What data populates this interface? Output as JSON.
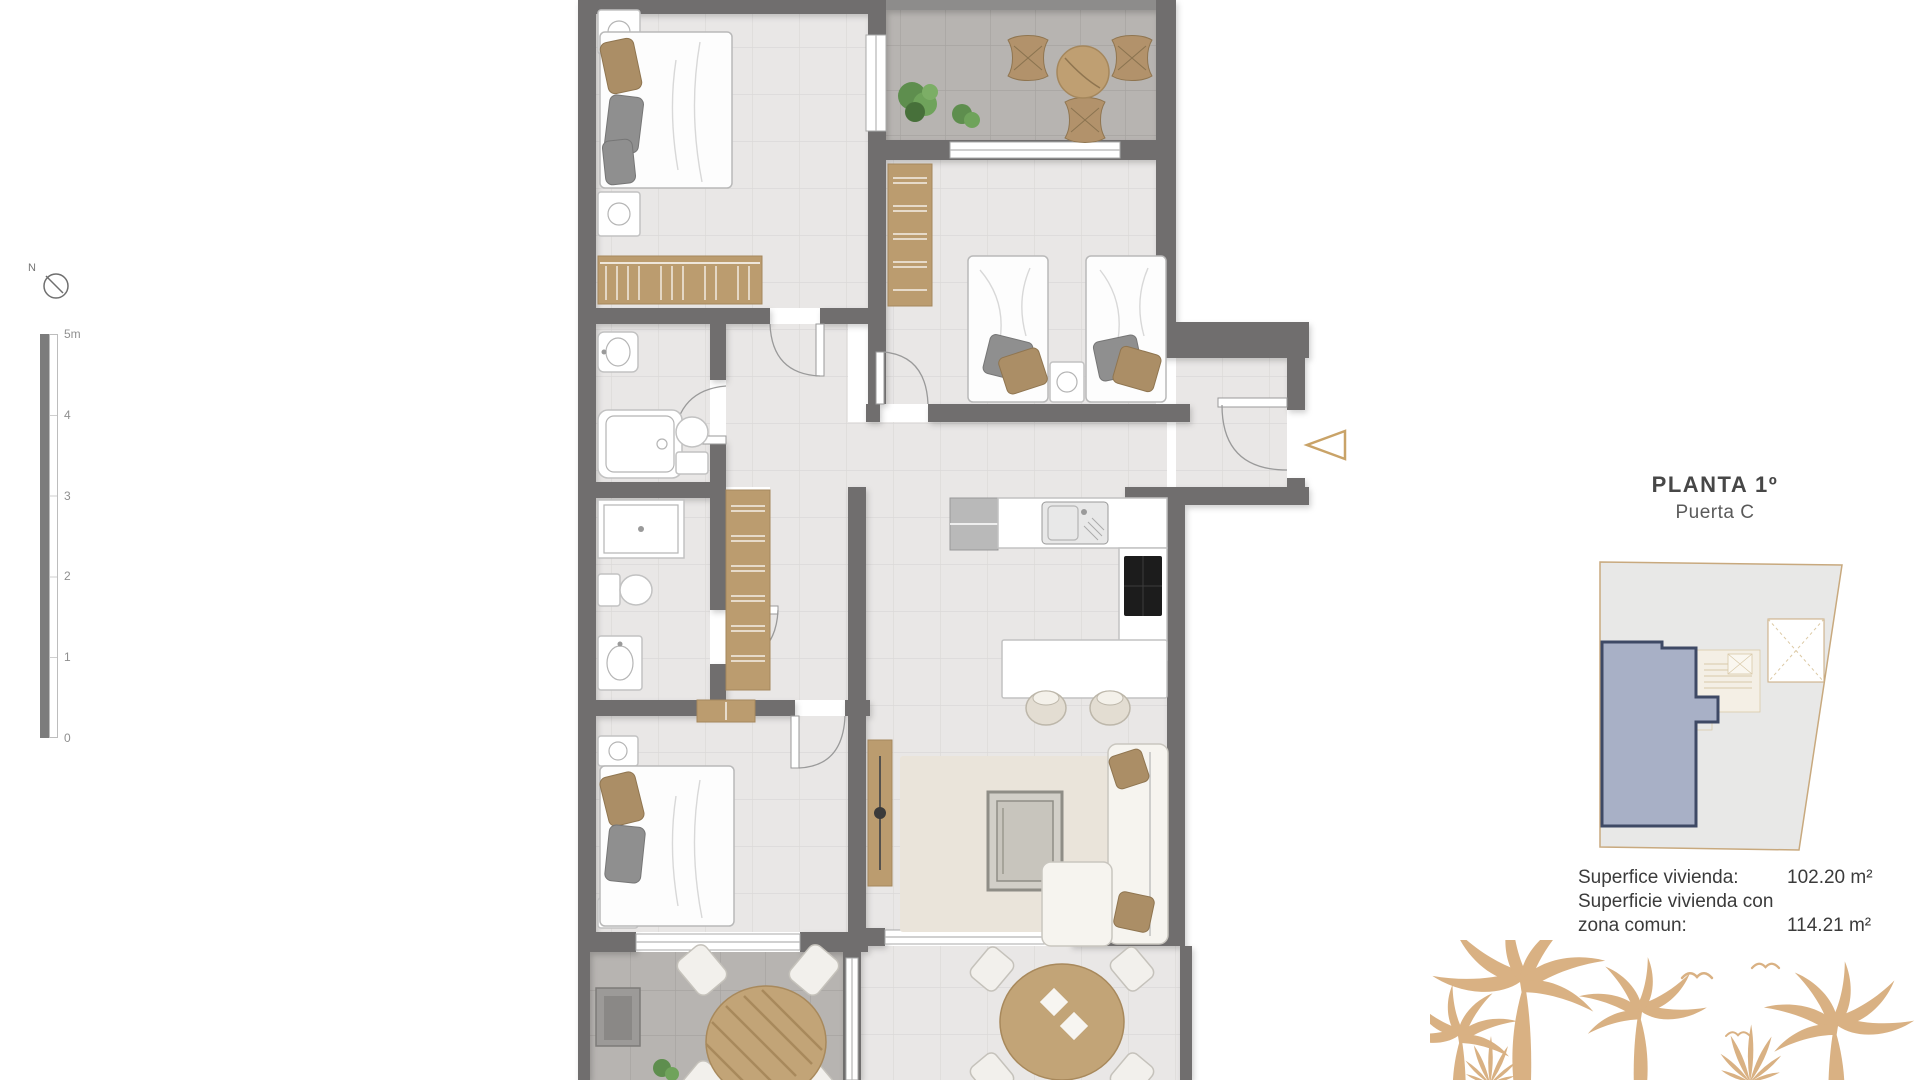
{
  "north": {
    "label": "N"
  },
  "scale_bar": {
    "labels": [
      "5m",
      "4",
      "3",
      "2",
      "1",
      "0"
    ]
  },
  "panel": {
    "title": "PLANTA 1º",
    "subtitle": "Puerta C"
  },
  "areas": {
    "rows": [
      {
        "label": "Superfice vivienda:",
        "value": "102.20 m²"
      },
      {
        "label_line1": "Superficie vivienda con",
        "label_line2": "zona comun:",
        "value": "114.21 m²"
      }
    ]
  },
  "colors": {
    "wall": "#6f6e6e",
    "floor": "#e9e7e6",
    "floor_line": "#dbd9d8",
    "terrace": "#b7b4b1",
    "terrace_line": "#a7a4a1",
    "tan": "#bb9c6f",
    "tan_dark": "#a5875c",
    "accent_arrow": "#c9a368",
    "unit_fill": "#a8b0c6",
    "unit_border": "#3e4965",
    "map_bg": "#e8e8e7",
    "map_outline": "#c8a97e",
    "palm": "#d9b183",
    "text_dark": "#474747",
    "text_mid": "#5a5a5a",
    "text_area": "#3b3b3b",
    "scale_gray": "#7c7c7c",
    "label_gray": "#8f8f8f"
  }
}
